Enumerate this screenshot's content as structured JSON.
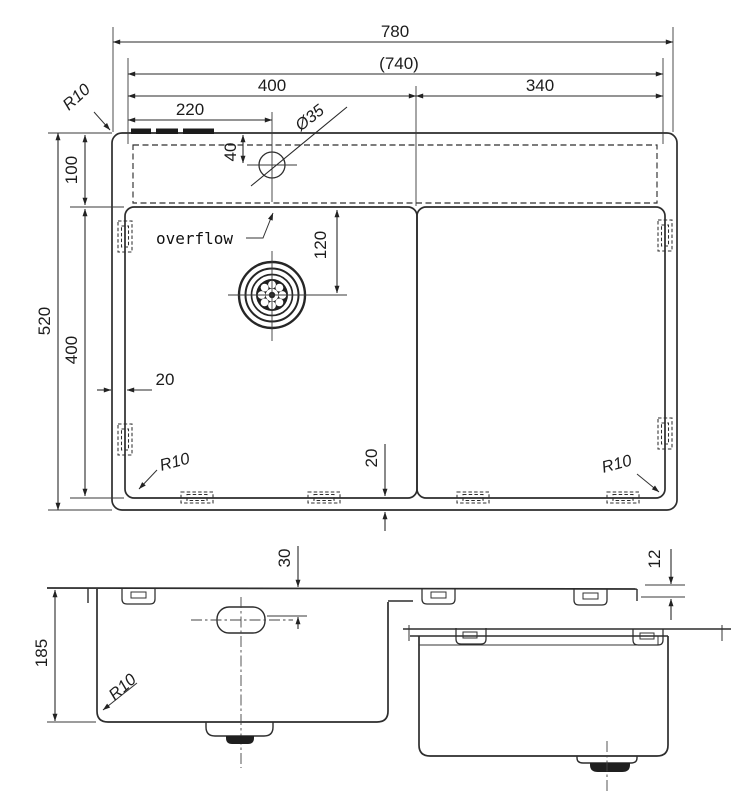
{
  "top_view": {
    "overall_width": "780",
    "inner_width": "(740)",
    "left_bowl_width": "400",
    "right_bowl_width": "340",
    "faucet_offset": "220",
    "faucet_hole_dia": "Ø35",
    "faucet_from_edge": "40",
    "deck_depth": "100",
    "overall_depth": "520",
    "bowl_front_back": "400",
    "drain_from_back": "120",
    "margin_left": "20",
    "margin_bottom": "20",
    "overflow_label": "overflow",
    "radius_top_left": "R10",
    "radius_bottom_left": "R10",
    "radius_bottom_right": "R10"
  },
  "front_view": {
    "overflow_from_rim": "30",
    "bowl_depth": "185",
    "bottom_radius": "R10",
    "rim_drop": "12"
  }
}
